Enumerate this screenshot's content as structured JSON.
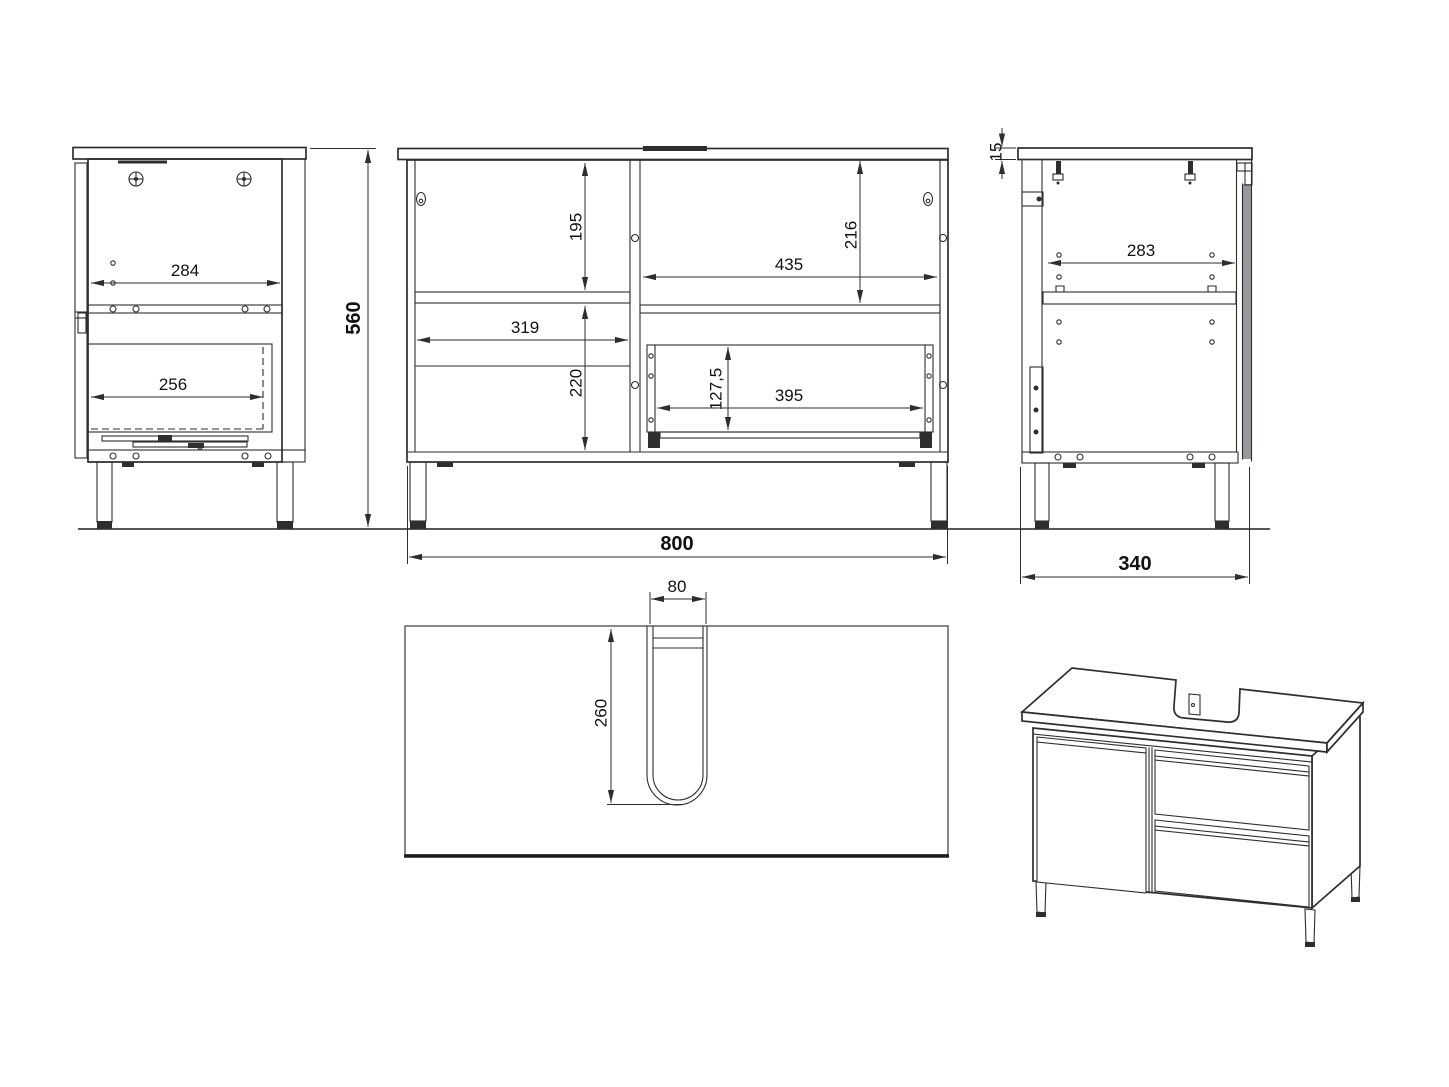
{
  "colors": {
    "line": "#2e2e2e",
    "text": "#111111",
    "door_shade": "#949a9d",
    "background": "#ffffff"
  },
  "dimensions": {
    "side_left": {
      "back_width": "284",
      "drawer_depth": "256"
    },
    "front": {
      "overall_width": "800",
      "overall_height": "560",
      "left_top_height": "195",
      "left_width": "319",
      "left_bottom_height": "220",
      "right_top_height": "216",
      "right_width": "435",
      "drawer_width": "395",
      "drawer_height": "127,5"
    },
    "side_right": {
      "top_thickness": "15",
      "inner_width": "283",
      "overall_depth": "340"
    },
    "top": {
      "cutout_width": "80",
      "cutout_depth": "260"
    }
  }
}
